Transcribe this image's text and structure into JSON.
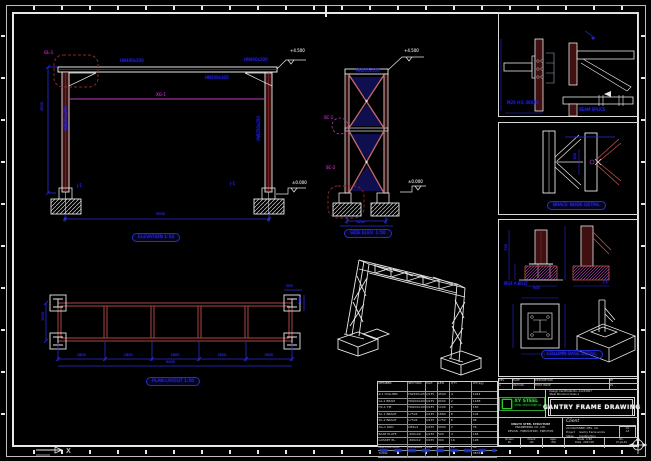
{
  "canvas": {
    "bg": "#000000"
  },
  "colors": {
    "line": "#e8e8e8",
    "column_fill": "#3f100f",
    "brace": "#c56a6a",
    "plan_red": "#b04545",
    "dim": "#2b2bdd",
    "label": "#2d2dff",
    "magenta": "#c23ac2",
    "cloud": "#8a2a2a",
    "green": "#35c135"
  },
  "views": {
    "front_elevation": {
      "title": "ELEVATION 1:50",
      "levels": {
        "top": "+4.500",
        "base": "±0.000"
      },
      "dims": {
        "height": "4500",
        "span": "9000"
      },
      "labels": {
        "beam": "GL-1",
        "beam_size": "HN400x200",
        "tie": "XG-1",
        "tie_size": "HN200x100",
        "col": "HW250x250",
        "foot": "J-1"
      }
    },
    "side_elevation": {
      "title": "SIDE ELEV. 1:50",
      "levels": {
        "top": "+4.500",
        "base": "±0.000"
      },
      "dims": {
        "base": "1200"
      },
      "labels": {
        "cap": "HN200x100",
        "brace_upper": "SC-1",
        "brace_lower": "SC-2"
      }
    },
    "plan": {
      "title": "PLAN LAYOUT 1:50",
      "bay_dims": [
        "1800",
        "1800",
        "1800",
        "1800",
        "1800"
      ],
      "total_dim": "9000",
      "side_dim": "1500",
      "corner_dim_h": "500",
      "corner_dim_v": "500"
    }
  },
  "details": {
    "panel1": {
      "note_bolts": "M20 H.S. BOLTS",
      "note_splice": "BEAM SPLICE"
    },
    "panel2": {
      "title": "BRACE NODE DETAIL",
      "dim": "350"
    },
    "panel3": {
      "title": "COLUMN BASE DETAIL",
      "note_bolt": "M24 A.BOLT",
      "label_footing": "J-1",
      "dim_w": "500",
      "dim_h": "700"
    }
  },
  "bom": {
    "headers": [
      "MEMBER",
      "SECTION",
      "MAT.",
      "LEN",
      "QTY",
      "WT(kg)"
    ],
    "rows": [
      [
        "Z-1 COLUMN",
        "HW250x250",
        "Q235",
        "4500",
        "4",
        "1944"
      ],
      [
        "GL-1 BEAM",
        "HN400x200",
        "Q235",
        "9000",
        "2",
        "1188"
      ],
      [
        "HC-1 TIE",
        "HN200x100",
        "Q235",
        "1200",
        "6",
        "150"
      ],
      [
        "SC-1 BRACE",
        "L75x6",
        "Q235",
        "1860",
        "8",
        "104"
      ],
      [
        "SC-2 BRACE",
        "L75x6",
        "Q235",
        "1750",
        "8",
        "96"
      ],
      [
        "XG-1 ROD",
        "D89x4",
        "Q235",
        "9000",
        "2",
        "76"
      ],
      [
        "BASE PLATE",
        "-500x20",
        "Q235",
        "500",
        "4",
        "156"
      ],
      [
        "GUSSET PL.",
        "-300x12",
        "Q235",
        "300",
        "16",
        "128"
      ],
      [
        "ANCHOR BOLT",
        "M24x600",
        "35#",
        "600",
        "16",
        "34"
      ],
      [
        "TOTAL",
        "",
        "",
        "",
        "",
        "3876"
      ]
    ]
  },
  "title_block": {
    "revision": {
      "cols": [
        "REV",
        "DATE",
        "DESCRIPTION",
        "BY"
      ],
      "values": [
        "A",
        "2023.06",
        "FIRST ISSUE",
        "ZL"
      ]
    },
    "logo": {
      "name": "XY STEEL",
      "en": "STEEL STRUCTURE CO."
    },
    "cert": {
      "line1": "Design Certificate No. A1234567",
      "line2": "Steel Structure Class-1"
    },
    "main_title": "GANTRY FRAME DRAWING",
    "company": {
      "line1": "XINGYU STEEL STRUCTURE",
      "line2": "ENGINEERING CO., LTD.",
      "line3": "DESIGN - FABRICATION - ERECTION"
    },
    "client_label": "Client",
    "client_value": "XX MACHINERY MFG. CO.",
    "project_label": "Project",
    "project_value": "Gantry frame works",
    "stage_label": "Stage",
    "stage_value": "Construction",
    "sheet": {
      "line1": "1/1",
      "line2": "A3"
    },
    "drawn_label": "Drawn",
    "drawn": "ZL",
    "checked_label": "Check",
    "checked": "LM",
    "approved_label": "Appr.",
    "approved": "WQ",
    "scale_label": "Scale",
    "scale": "1:50",
    "date_label": "Date",
    "date": "2023.06",
    "dwg_label": "No.",
    "dwg_no": "XY-JG-01"
  },
  "ucs": {
    "x": "X"
  }
}
